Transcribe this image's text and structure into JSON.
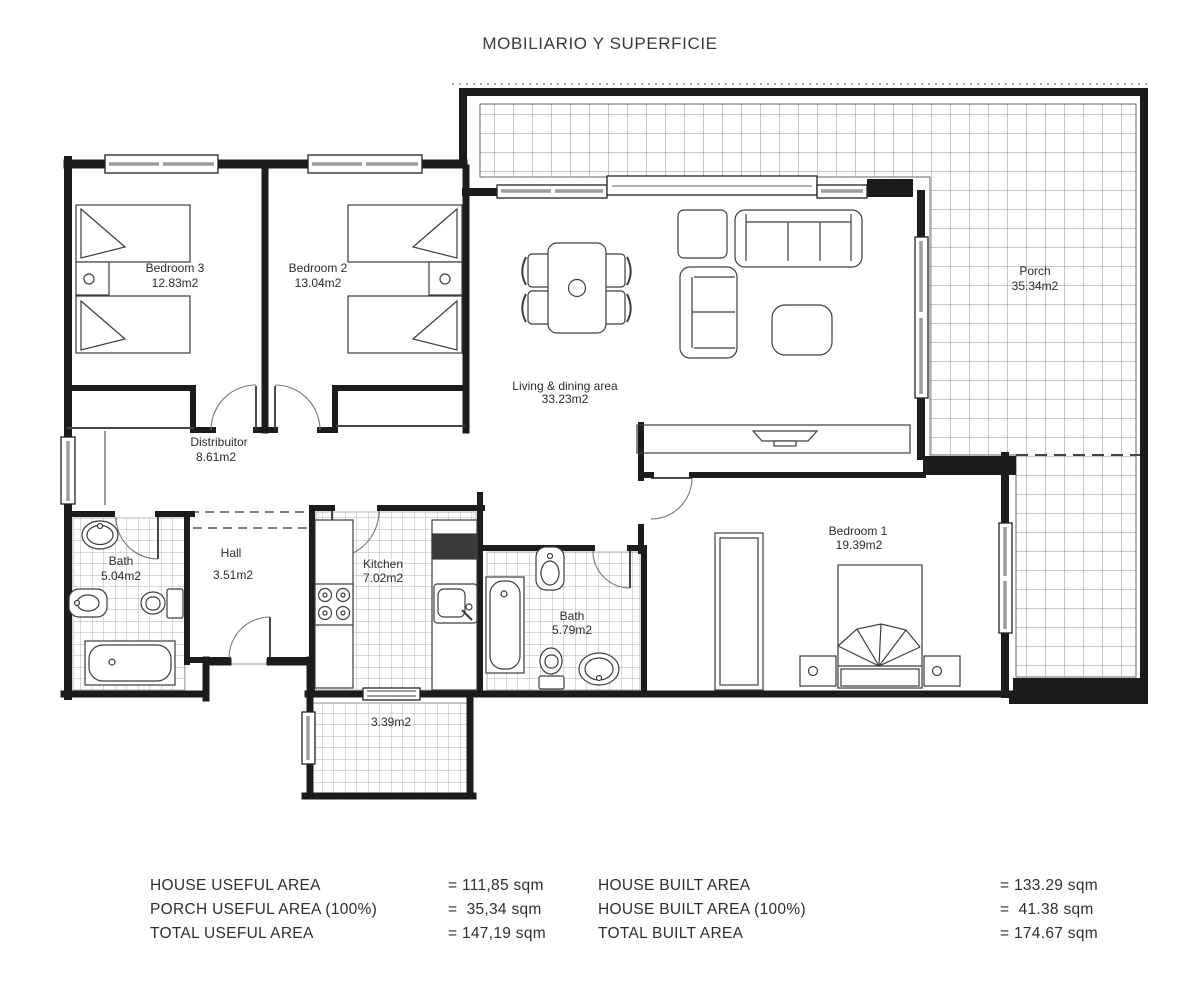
{
  "title": "MOBILIARIO Y SUPERFICIE",
  "rooms": [
    {
      "name": "Bedroom 3",
      "area": "12.83m2"
    },
    {
      "name": "Bedroom 2",
      "area": "13.04m2"
    },
    {
      "name": "Living & dining area",
      "area": "33.23m2"
    },
    {
      "name": "Porch",
      "area": "35.34m2"
    },
    {
      "name": "Distribuitor",
      "area": "8.61m2"
    },
    {
      "name": "Bath",
      "area": "5.04m2"
    },
    {
      "name": "Hall",
      "area": "3.51m2"
    },
    {
      "name": "Kitchen",
      "area": "7.02m2"
    },
    {
      "name": "Bath",
      "area": "5.79m2"
    },
    {
      "name": "Bedroom 1",
      "area": "19.39m2"
    },
    {
      "name": "",
      "area": "3.39m2"
    }
  ],
  "summary": {
    "left": [
      {
        "label": "HOUSE USEFUL AREA",
        "value": "= 111,85 sqm"
      },
      {
        "label": "PORCH USEFUL AREA (100%)",
        "value": "=  35,34 sqm"
      },
      {
        "label": "TOTAL USEFUL AREA",
        "value": "= 147,19 sqm"
      }
    ],
    "right": [
      {
        "label": "HOUSE BUILT AREA",
        "value": "= 133.29 sqm"
      },
      {
        "label": "HOUSE BUILT AREA (100%)",
        "value": "=  41.38 sqm"
      },
      {
        "label": "TOTAL BUILT AREA",
        "value": "= 174.67 sqm"
      }
    ]
  },
  "colors": {
    "wall": "#1c1c1c",
    "tile_small": "#b3b3b3",
    "tile_large": "#8f8f8f",
    "window_bar": "#9c9c9c"
  }
}
